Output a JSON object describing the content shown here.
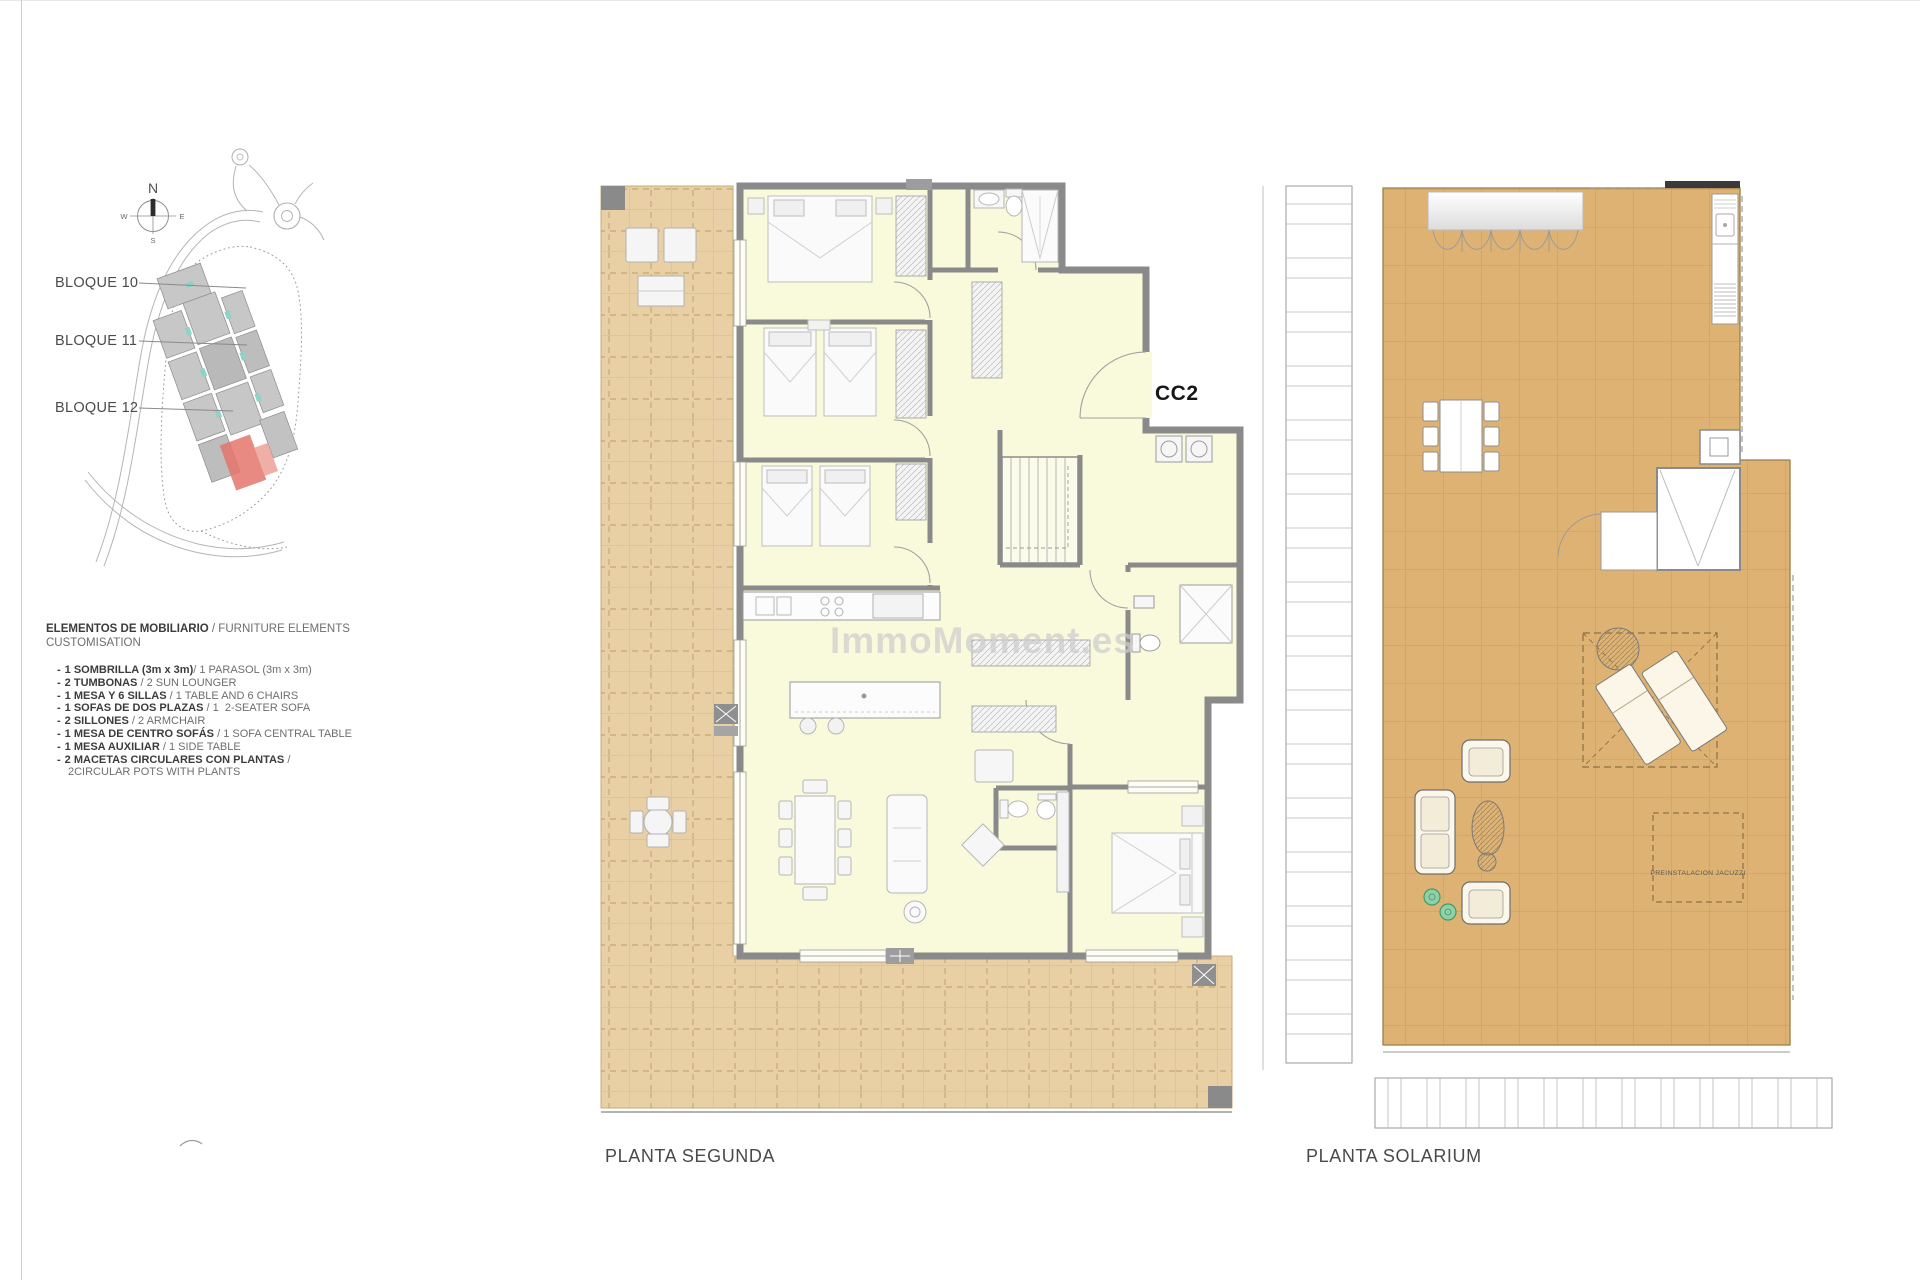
{
  "site_key": {
    "compass": {
      "north": "N",
      "south": "S",
      "east": "E",
      "west": "W"
    },
    "blocks": [
      {
        "label": "BLOQUE 10"
      },
      {
        "label": "BLOQUE 11"
      },
      {
        "label": "BLOQUE 12"
      }
    ]
  },
  "furniture_legend": {
    "bullet": "-",
    "heading_bold": "ELEMENTOS DE MOBILIARIO",
    "heading_rest": " / FURNITURE ELEMENTS",
    "heading_line2": "CUSTOMISATION",
    "items": [
      {
        "es": "1 SOMBRILLA (3m x 3m)",
        "sep": "/ ",
        "en": "1 PARASOL (3m x 3m)"
      },
      {
        "es": "2 TUMBONAS",
        "sep": " / ",
        "en": "2 SUN LOUNGER"
      },
      {
        "es": "1 MESA Y 6 SILLAS",
        "sep": " / ",
        "en": "1 TABLE AND 6 CHAIRS"
      },
      {
        "es": "1 SOFAS DE DOS PLAZAS",
        "sep": " / ",
        "en": "1  2-SEATER SOFA"
      },
      {
        "es": "2 SILLONES",
        "sep": " / ",
        "en": "2 ARMCHAIR"
      },
      {
        "es": "1 MESA DE CENTRO SOFÁS",
        "sep": " / ",
        "en": "1 SOFA CENTRAL TABLE"
      },
      {
        "es": "1 MESA AUXILIAR",
        "sep": " / ",
        "en": "1 SIDE TABLE"
      },
      {
        "es": "2 MACETAS CIRCULARES CON PLANTAS",
        "sep": " /",
        "en": "2CIRCULAR POTS WITH PLANTS"
      }
    ]
  },
  "plans": {
    "second_floor": {
      "label": "PLANTA SEGUNDA",
      "unit_code": "CC2"
    },
    "solarium": {
      "label": "PLANTA SOLARIUM",
      "jacuzzi_note": "PREINSTALACION JACUZZI"
    }
  },
  "watermark": "ImmoMoment.es",
  "colors": {
    "terrace": "#e8cfa4",
    "solarium_deck": "#deb273",
    "interior": "#f9fadc",
    "wall": "#8a8a8a",
    "unit_highlight": "#e4766b",
    "plant_green": "#8fd0a8",
    "watermark_gray": "#cdcdcd"
  }
}
